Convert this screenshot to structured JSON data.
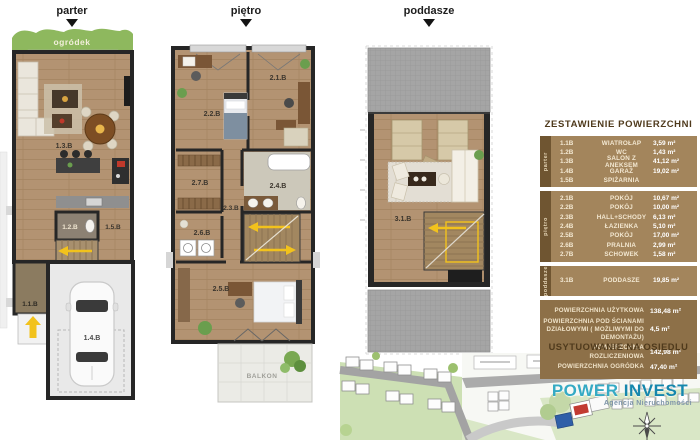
{
  "plans": {
    "parter": {
      "title": "parter",
      "garden": "ogródek",
      "living": "1.3.B",
      "wc": "1.2.B",
      "pantry": "1.5.B",
      "entry": "1.1.B",
      "garage": "1.4.B"
    },
    "pietro": {
      "title": "piętro",
      "room_tr": "2.1.B",
      "room_tl": "2.2.B",
      "hall": "2.3.B",
      "bath": "2.4.B",
      "bedroom": "2.5.B",
      "laundry": "2.6.B",
      "storage": "2.7.B",
      "balcony": "BALKON"
    },
    "poddasze": {
      "title": "poddasze",
      "attic": "3.1.B"
    }
  },
  "table": {
    "title": "ZESTAWIENIE POWIERZCHNI",
    "sections": [
      {
        "label": "parter",
        "rows": [
          [
            "1.1B",
            "WIATROŁAP",
            "3,59 m²"
          ],
          [
            "1.2B",
            "WC",
            "1,43 m²"
          ],
          [
            "1.3B",
            "SALON Z ANEKSEM",
            "41,12 m²"
          ],
          [
            "1.4B",
            "GARAŻ",
            "19,02 m²"
          ],
          [
            "1.5B",
            "SPIŻARNIA",
            ""
          ]
        ]
      },
      {
        "label": "piętro",
        "rows": [
          [
            "2.1B",
            "POKÓJ",
            "10,67 m²"
          ],
          [
            "2.2B",
            "POKÓJ",
            "10,00 m²"
          ],
          [
            "2.3B",
            "HALL+SCHODY",
            "6,13 m²"
          ],
          [
            "2.4B",
            "ŁAZIENKA",
            "5,10 m²"
          ],
          [
            "2.5B",
            "POKÓJ",
            "17,00 m²"
          ],
          [
            "2.6B",
            "PRALNIA",
            "2,99 m²"
          ],
          [
            "2.7B",
            "SCHOWEK",
            "1,58 m²"
          ]
        ]
      },
      {
        "label": "poddasze",
        "rows": [
          [
            "3.1B",
            "PODDASZE",
            "19,85 m²"
          ]
        ]
      }
    ],
    "summary": [
      {
        "label": "POWIERZCHNIA UŻYTKOWA",
        "value": "138,48 m²"
      },
      {
        "label": "POWIERZCHNIA POD ŚCIANAMI DZIAŁOWYMI ( MOŻLIWYMI DO DEMONTAŻU)",
        "value": "4,5 m²"
      },
      {
        "label": "POWIERZCHNIA ROZLICZENIOWA",
        "value": "142,98 m²"
      },
      {
        "label": "POWIERZCHNIA OGRÓDKA",
        "value": "47,40 m²"
      }
    ]
  },
  "site": {
    "title": "USYTUOWANIE NA OSIEDLU"
  },
  "logo": {
    "power": "POWER",
    "invest": "INVEST",
    "subtitle": "Agencja Nieruchomości"
  },
  "colors": {
    "table_tan": "#a3855c",
    "table_dark_strip": "#6f5531",
    "summary_bg": "#8d7048",
    "header_brown": "#4f3a1c",
    "wood_floor": "#b39372",
    "wall_dark": "#262626",
    "garden_green": "#8eb85e",
    "roof_gray": "#a5a5a5",
    "arrow_yellow": "#f2c21c",
    "site_green": "#cde0b4",
    "logo_teal": "#2ea9c5"
  }
}
